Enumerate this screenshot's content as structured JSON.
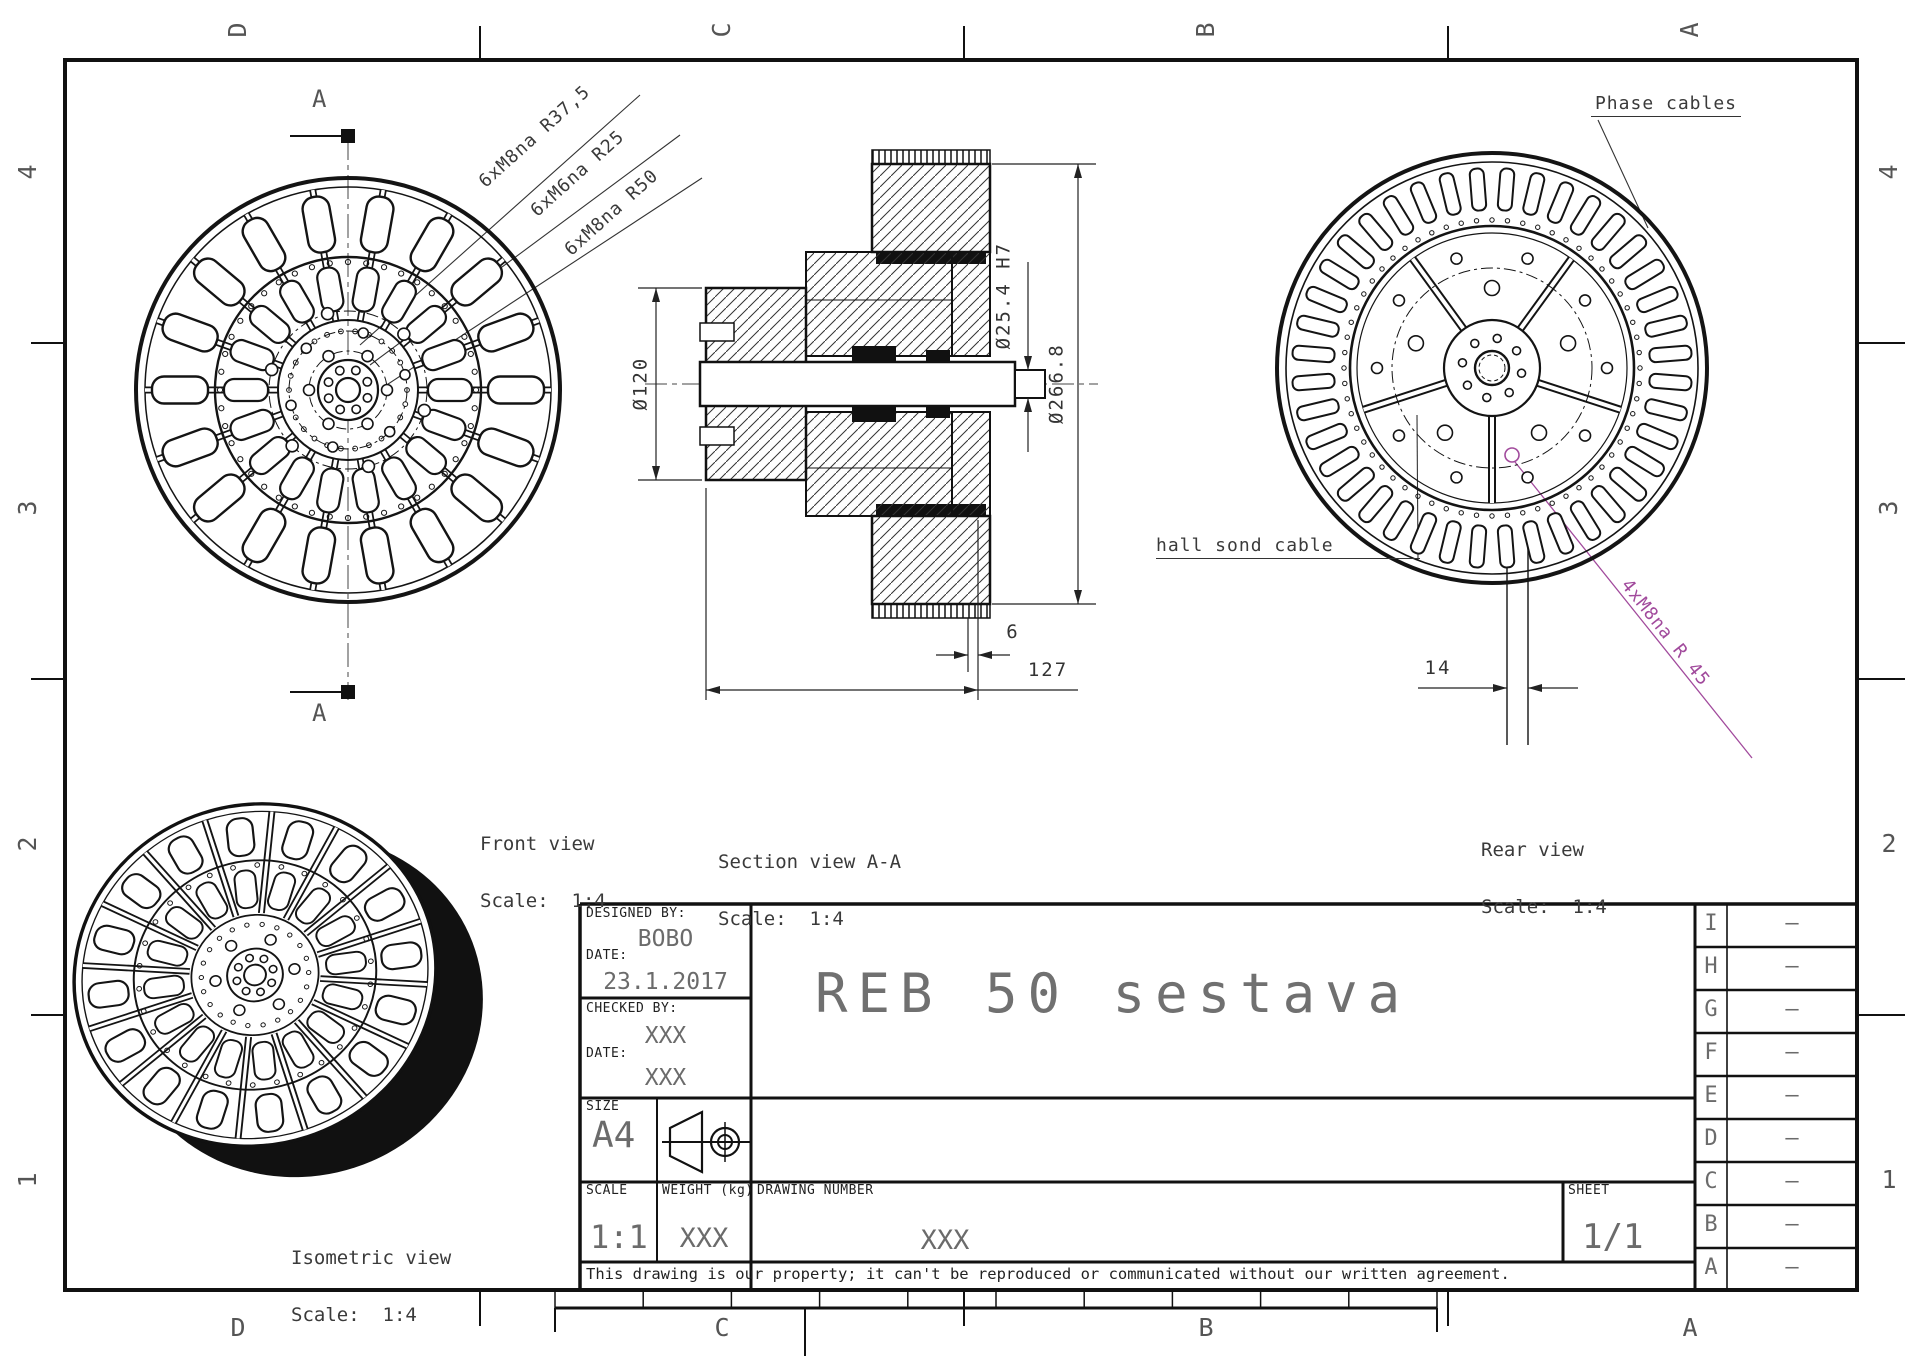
{
  "border": {
    "zone_letters_top": [
      "D",
      "C",
      "B",
      "A"
    ],
    "zone_letters_bottom": [
      "D",
      "C",
      "B",
      "A"
    ],
    "zone_numbers_left": [
      "4",
      "3",
      "2",
      "1"
    ],
    "zone_numbers_right": [
      "4",
      "3",
      "2",
      "1"
    ]
  },
  "views": {
    "front": {
      "label": "Front view",
      "scale_label": "Scale:  1:4"
    },
    "section": {
      "label": "Section view A-A",
      "scale_label": "Scale:  1:4"
    },
    "rear": {
      "label": "Rear view",
      "scale_label": "Scale:  1:4"
    },
    "isometric": {
      "label": "Isometric view",
      "scale_label": "Scale:  1:4"
    }
  },
  "annotations": {
    "front_thread_1": "6xM8na R37,5",
    "front_thread_2": "6xM6na R25",
    "front_thread_3": "6xM8na R50",
    "phase_cables": "Phase cables",
    "hall_cable": "hall sond cable",
    "rear_thread": "4xM8na R 45",
    "section_marker": "A"
  },
  "dimensions": {
    "flange_diameter": "Ø120",
    "bore_diameter": "Ø25.4 H7",
    "outer_diameter": "Ø266.8",
    "offset": "6",
    "width": "127",
    "shaft_width": "14"
  },
  "title_block": {
    "designed_by_label": "DESIGNED BY:",
    "designed_by": "BOBO",
    "date_label": "DATE:",
    "design_date": "23.1.2017",
    "checked_by_label": "CHECKED BY:",
    "checked_by": "XXX",
    "check_date": "XXX",
    "size_label": "SIZE",
    "size": "A4",
    "scale_label": "SCALE",
    "scale": "1:1",
    "weight_label": "WEIGHT (kg)",
    "weight": "XXX",
    "drawing_number_label": "DRAWING NUMBER",
    "drawing_number": "XXX",
    "sheet_label": "SHEET",
    "sheet": "1/1",
    "title": "REB 50 sestava",
    "disclaimer": "This drawing is our property; it can't be reproduced or communicated without our written agreement."
  },
  "revision_table": {
    "rows": [
      {
        "letter": "I",
        "value": "–"
      },
      {
        "letter": "H",
        "value": "–"
      },
      {
        "letter": "G",
        "value": "–"
      },
      {
        "letter": "F",
        "value": "–"
      },
      {
        "letter": "E",
        "value": "–"
      },
      {
        "letter": "D",
        "value": "–"
      },
      {
        "letter": "C",
        "value": "–"
      },
      {
        "letter": "B",
        "value": "–"
      },
      {
        "letter": "A",
        "value": "–"
      }
    ]
  },
  "colors": {
    "accent_magenta": "#a14a9c",
    "line": "#141414",
    "cad_text": "#555555"
  }
}
